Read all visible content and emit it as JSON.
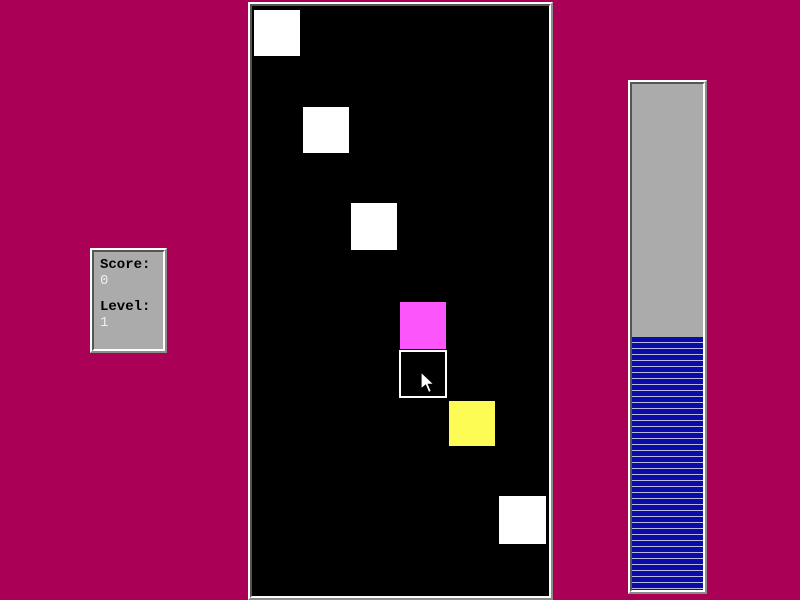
{
  "app": {
    "name": "falling-blocks-game"
  },
  "score_panel": {
    "score_label": "Score:",
    "score_value": "0",
    "level_label": "Level:",
    "level_value": "1"
  },
  "progress_bar": {
    "percent": 50
  },
  "colors": {
    "bg": "#aa0055",
    "panel_fill": "#ababab",
    "bevel_light": "#ffffff",
    "bevel_mid": "#8c8c8c",
    "bevel_dark": "#555555",
    "field_bg": "#000000",
    "label_text": "#000000",
    "value_text": "#efefef",
    "stripe_blue": "#0b0baa",
    "stripe_gap": "#b9b9d9",
    "block_white": "#ffffff",
    "block_magenta": "#fc55fc",
    "block_yellow": "#fcfc55"
  },
  "field": {
    "blocks": [
      {
        "name": "white-block-1",
        "type": "solid",
        "color": "#ffffff",
        "x": 2,
        "y": 4,
        "w": 46,
        "h": 46
      },
      {
        "name": "white-block-2",
        "type": "solid",
        "color": "#ffffff",
        "x": 51,
        "y": 101,
        "w": 46,
        "h": 46
      },
      {
        "name": "white-block-3",
        "type": "solid",
        "color": "#ffffff",
        "x": 99,
        "y": 197,
        "w": 46,
        "h": 47
      },
      {
        "name": "magenta-block",
        "type": "solid",
        "color": "#fc55fc",
        "x": 148,
        "y": 296,
        "w": 46,
        "h": 47
      },
      {
        "name": "selected-block",
        "type": "outline",
        "color": "#000000",
        "x": 147,
        "y": 344,
        "w": 48,
        "h": 48
      },
      {
        "name": "yellow-block",
        "type": "solid",
        "color": "#fcfc55",
        "x": 197,
        "y": 395,
        "w": 46,
        "h": 45
      },
      {
        "name": "white-block-4",
        "type": "solid",
        "color": "#ffffff",
        "x": 247,
        "y": 490,
        "w": 47,
        "h": 48
      }
    ]
  }
}
